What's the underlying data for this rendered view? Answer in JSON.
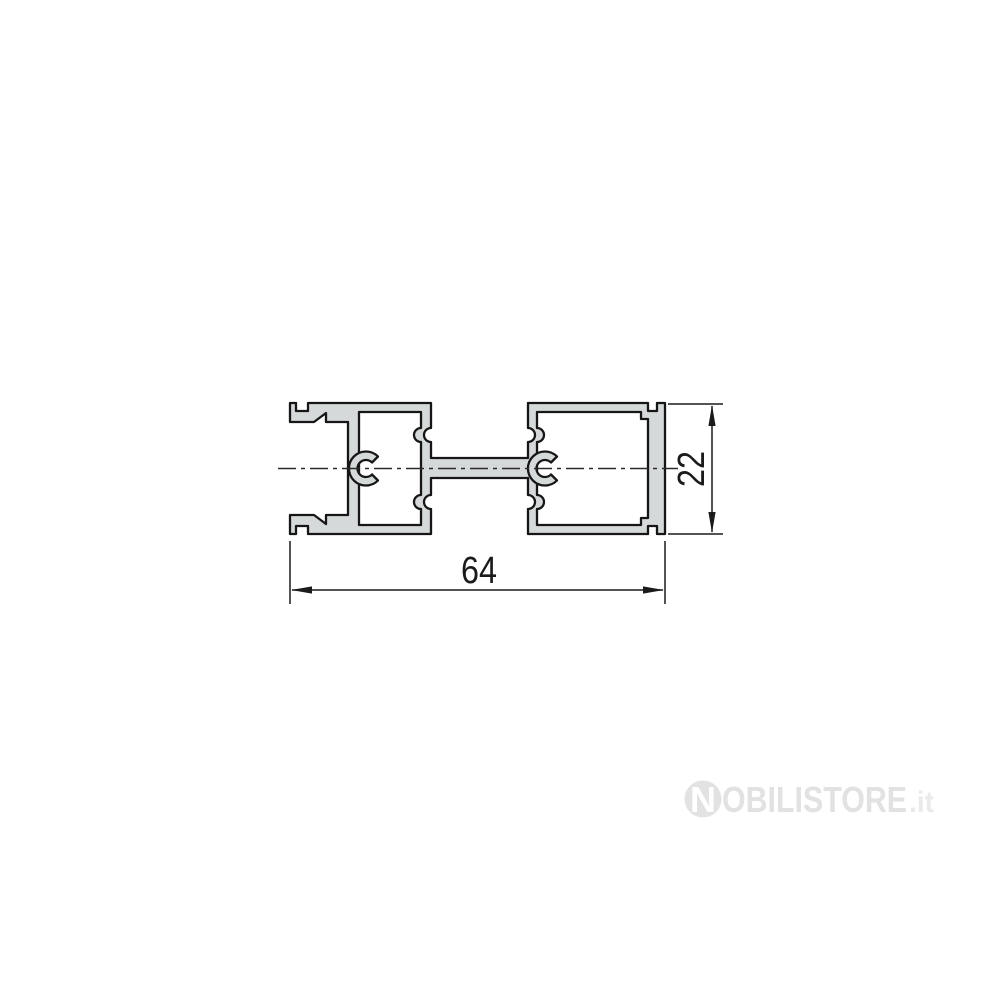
{
  "page": {
    "background": "#ffffff"
  },
  "drawing": {
    "kind": "aluminum-profile-cross-section",
    "description": "Technical 2D cross-section drawing of an aluminium frame profile: left glazing channel with gasket teeth, two hollow box chambers with C-shaped screw ports joined by a central web, thicker right face plate",
    "colors": {
      "profile_fill": "#d6d9da",
      "outline": "#161616",
      "dimension": "#1b1b1b",
      "centerline": "#2a2a2a"
    },
    "dimensions": {
      "width_label": "64",
      "height_label": "22"
    }
  },
  "watermark": {
    "logo_letter": "N",
    "brand": "OBILISTORE",
    "tld": ".it",
    "logo_fill": "#e2e2e2",
    "brand_fill": "#e2e2e2",
    "tld_fill": "#eaeaea",
    "letter_fill": "#ffffff"
  }
}
